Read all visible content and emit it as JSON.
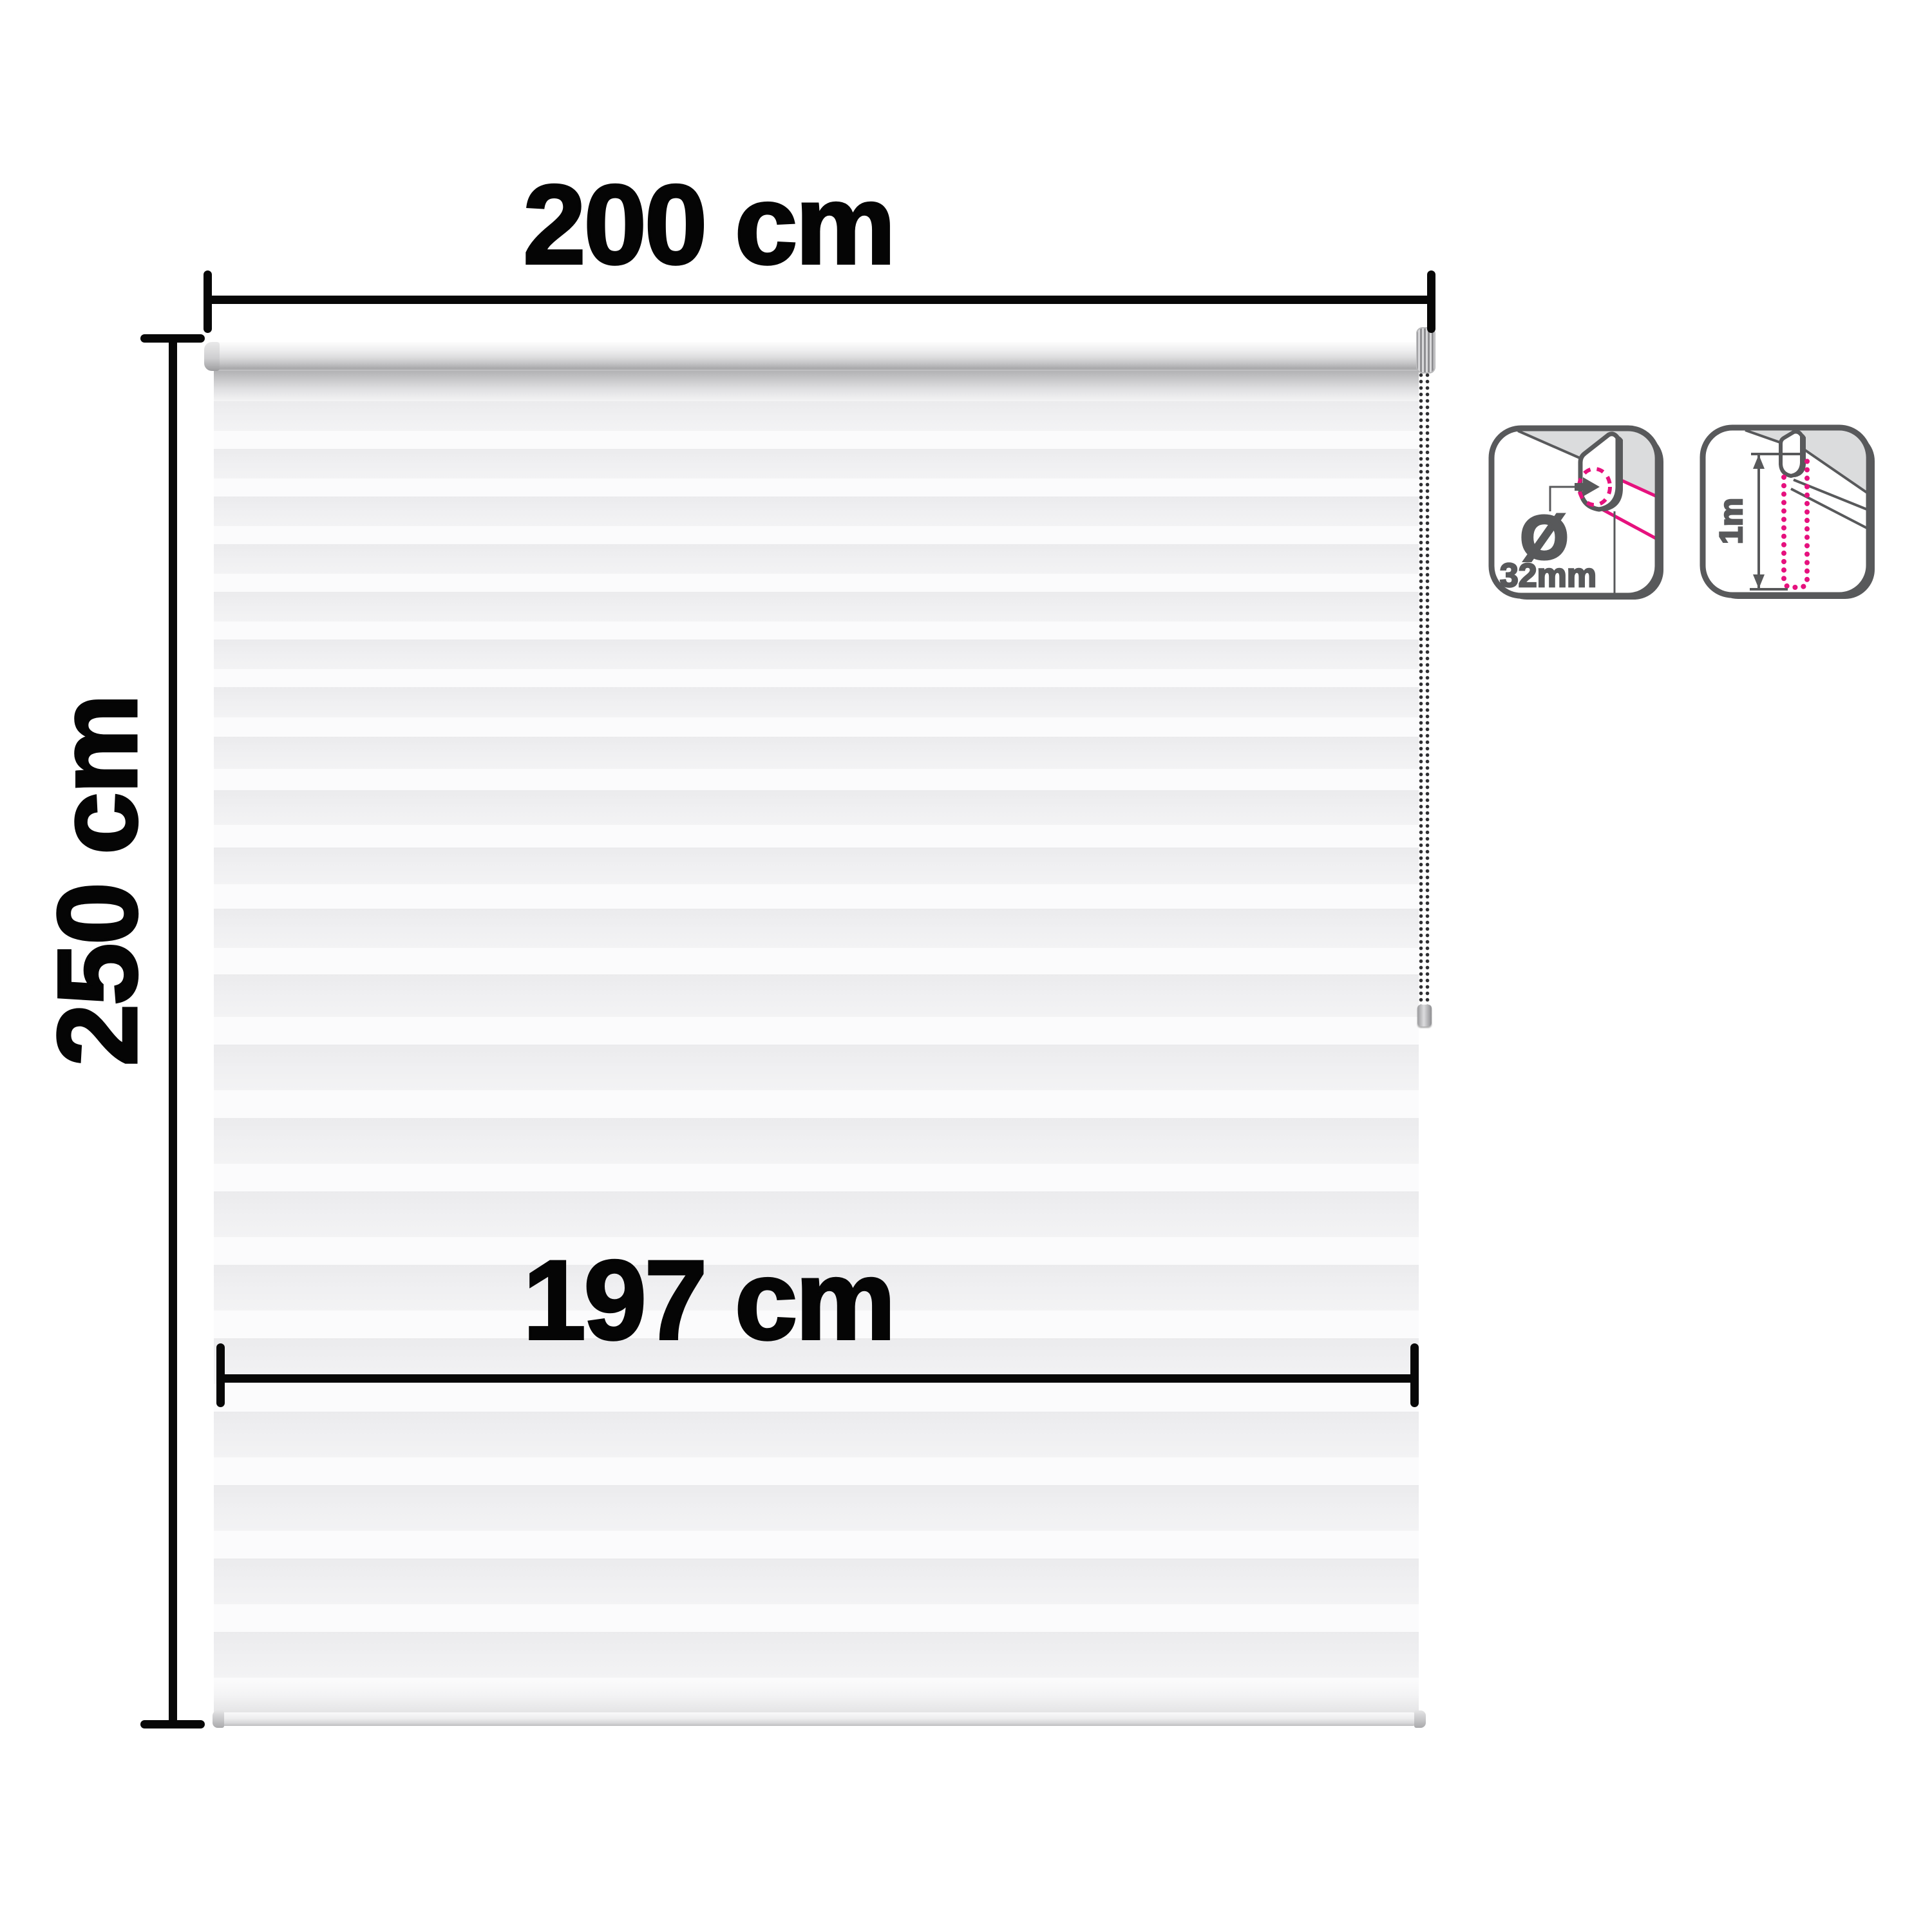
{
  "diagram": {
    "width_label": "200 cm",
    "height_label": "250 cm",
    "fabric_width_label": "197 cm"
  },
  "badges": {
    "tube_diameter": {
      "symbol": "Ø",
      "value": "32mm"
    },
    "chain_drop": {
      "value": "1m"
    }
  },
  "colors": {
    "dimension_black": "#070707",
    "icon_gray": "#58595b",
    "ceiling_gray": "#dbdcdd",
    "accent_pink": "#e6117e",
    "stripe_gray": "#efeff1",
    "stripe_white": "#fbfbfc"
  }
}
